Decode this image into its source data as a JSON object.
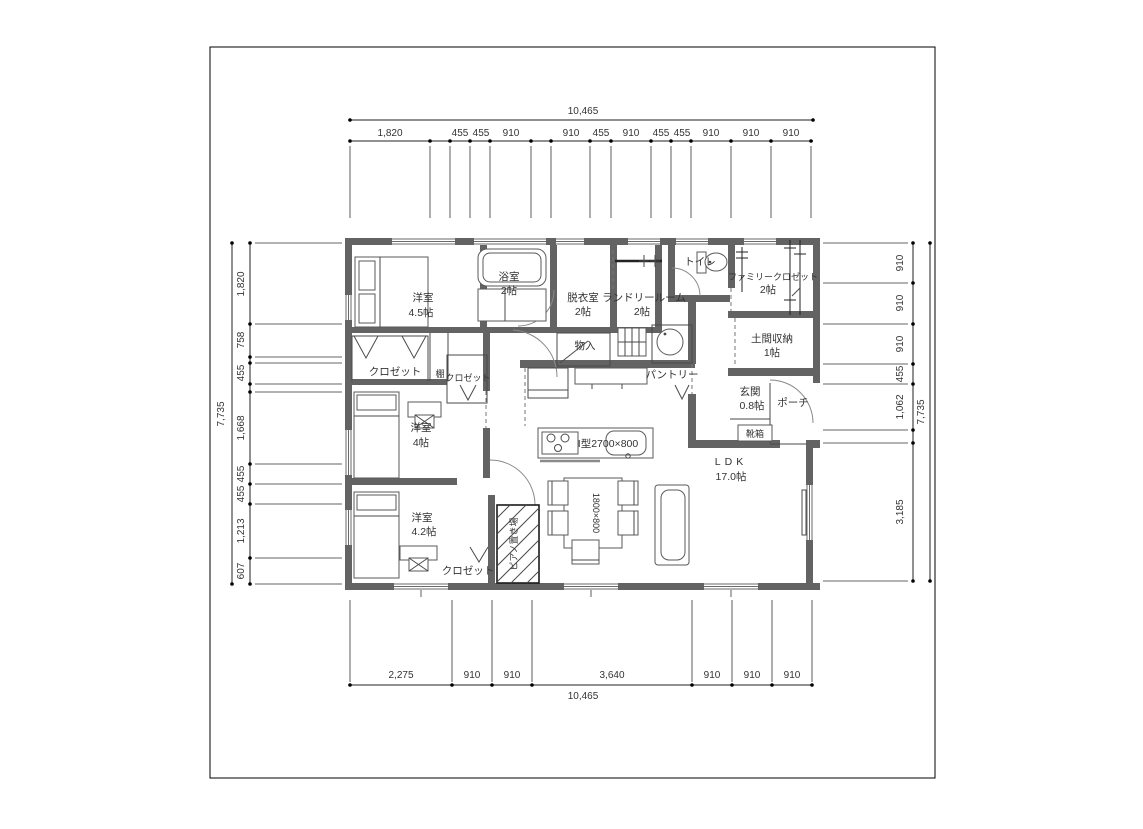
{
  "drawing": {
    "type": "floor-plan",
    "units": "mm"
  },
  "dimensions": {
    "top": {
      "overall": "10,465",
      "labels": [
        "1,820",
        "455",
        "455",
        "910",
        "910",
        "455",
        "910",
        "455",
        "455",
        "910",
        "910",
        "910"
      ]
    },
    "bottom": {
      "overall": "10,465",
      "labels": [
        "2,275",
        "910",
        "910",
        "3,640",
        "910",
        "910",
        "910"
      ]
    },
    "left": {
      "overall": "7,735",
      "labels": [
        "1,820",
        "758",
        "455",
        "1,668",
        "455",
        "455",
        "1,213",
        "607"
      ]
    },
    "right": {
      "overall": "7,735",
      "labels": [
        "910",
        "910",
        "910",
        "455",
        "1,062",
        "3,185"
      ]
    }
  },
  "rooms": {
    "bedroom_main": {
      "name": "洋室",
      "area": "4.5帖"
    },
    "bathroom": {
      "name": "浴室",
      "area": "2帖"
    },
    "dressing_room": {
      "name": "脱衣室",
      "area": "2帖"
    },
    "laundry_room": {
      "name": "ランドリールーム",
      "area": "2帖"
    },
    "toilet": {
      "name": "トイレ"
    },
    "family_closet": {
      "name": "ファミリークロゼット",
      "area": "2帖"
    },
    "doma_storage": {
      "name": "土間収納",
      "area": "1帖"
    },
    "entrance": {
      "name": "玄関",
      "area": "0.8帖"
    },
    "porch": {
      "name": "ポーチ"
    },
    "shoe_cabinet": {
      "name": "靴箱"
    },
    "closet_main": {
      "name": "クロゼット"
    },
    "shelf": {
      "name": "棚"
    },
    "closet_mid": {
      "name": "クロゼット"
    },
    "storage": {
      "name": "物入"
    },
    "pantry": {
      "name": "パントリー"
    },
    "bedroom_2": {
      "name": "洋室",
      "area": "4帖"
    },
    "bedroom_3": {
      "name": "洋室",
      "area": "4.2帖"
    },
    "closet_3": {
      "name": "クロゼット"
    },
    "piano_space": {
      "name": "ピアノ置き場"
    },
    "ldk": {
      "name": "LDK",
      "area": "17.0帖"
    },
    "kitchen": {
      "label": "I型2700×800"
    },
    "dining_table": {
      "label": "1800×800"
    }
  },
  "colors": {
    "wall": "#636363",
    "line": "#4a4a4a",
    "text": "#333333",
    "background": "#ffffff"
  }
}
